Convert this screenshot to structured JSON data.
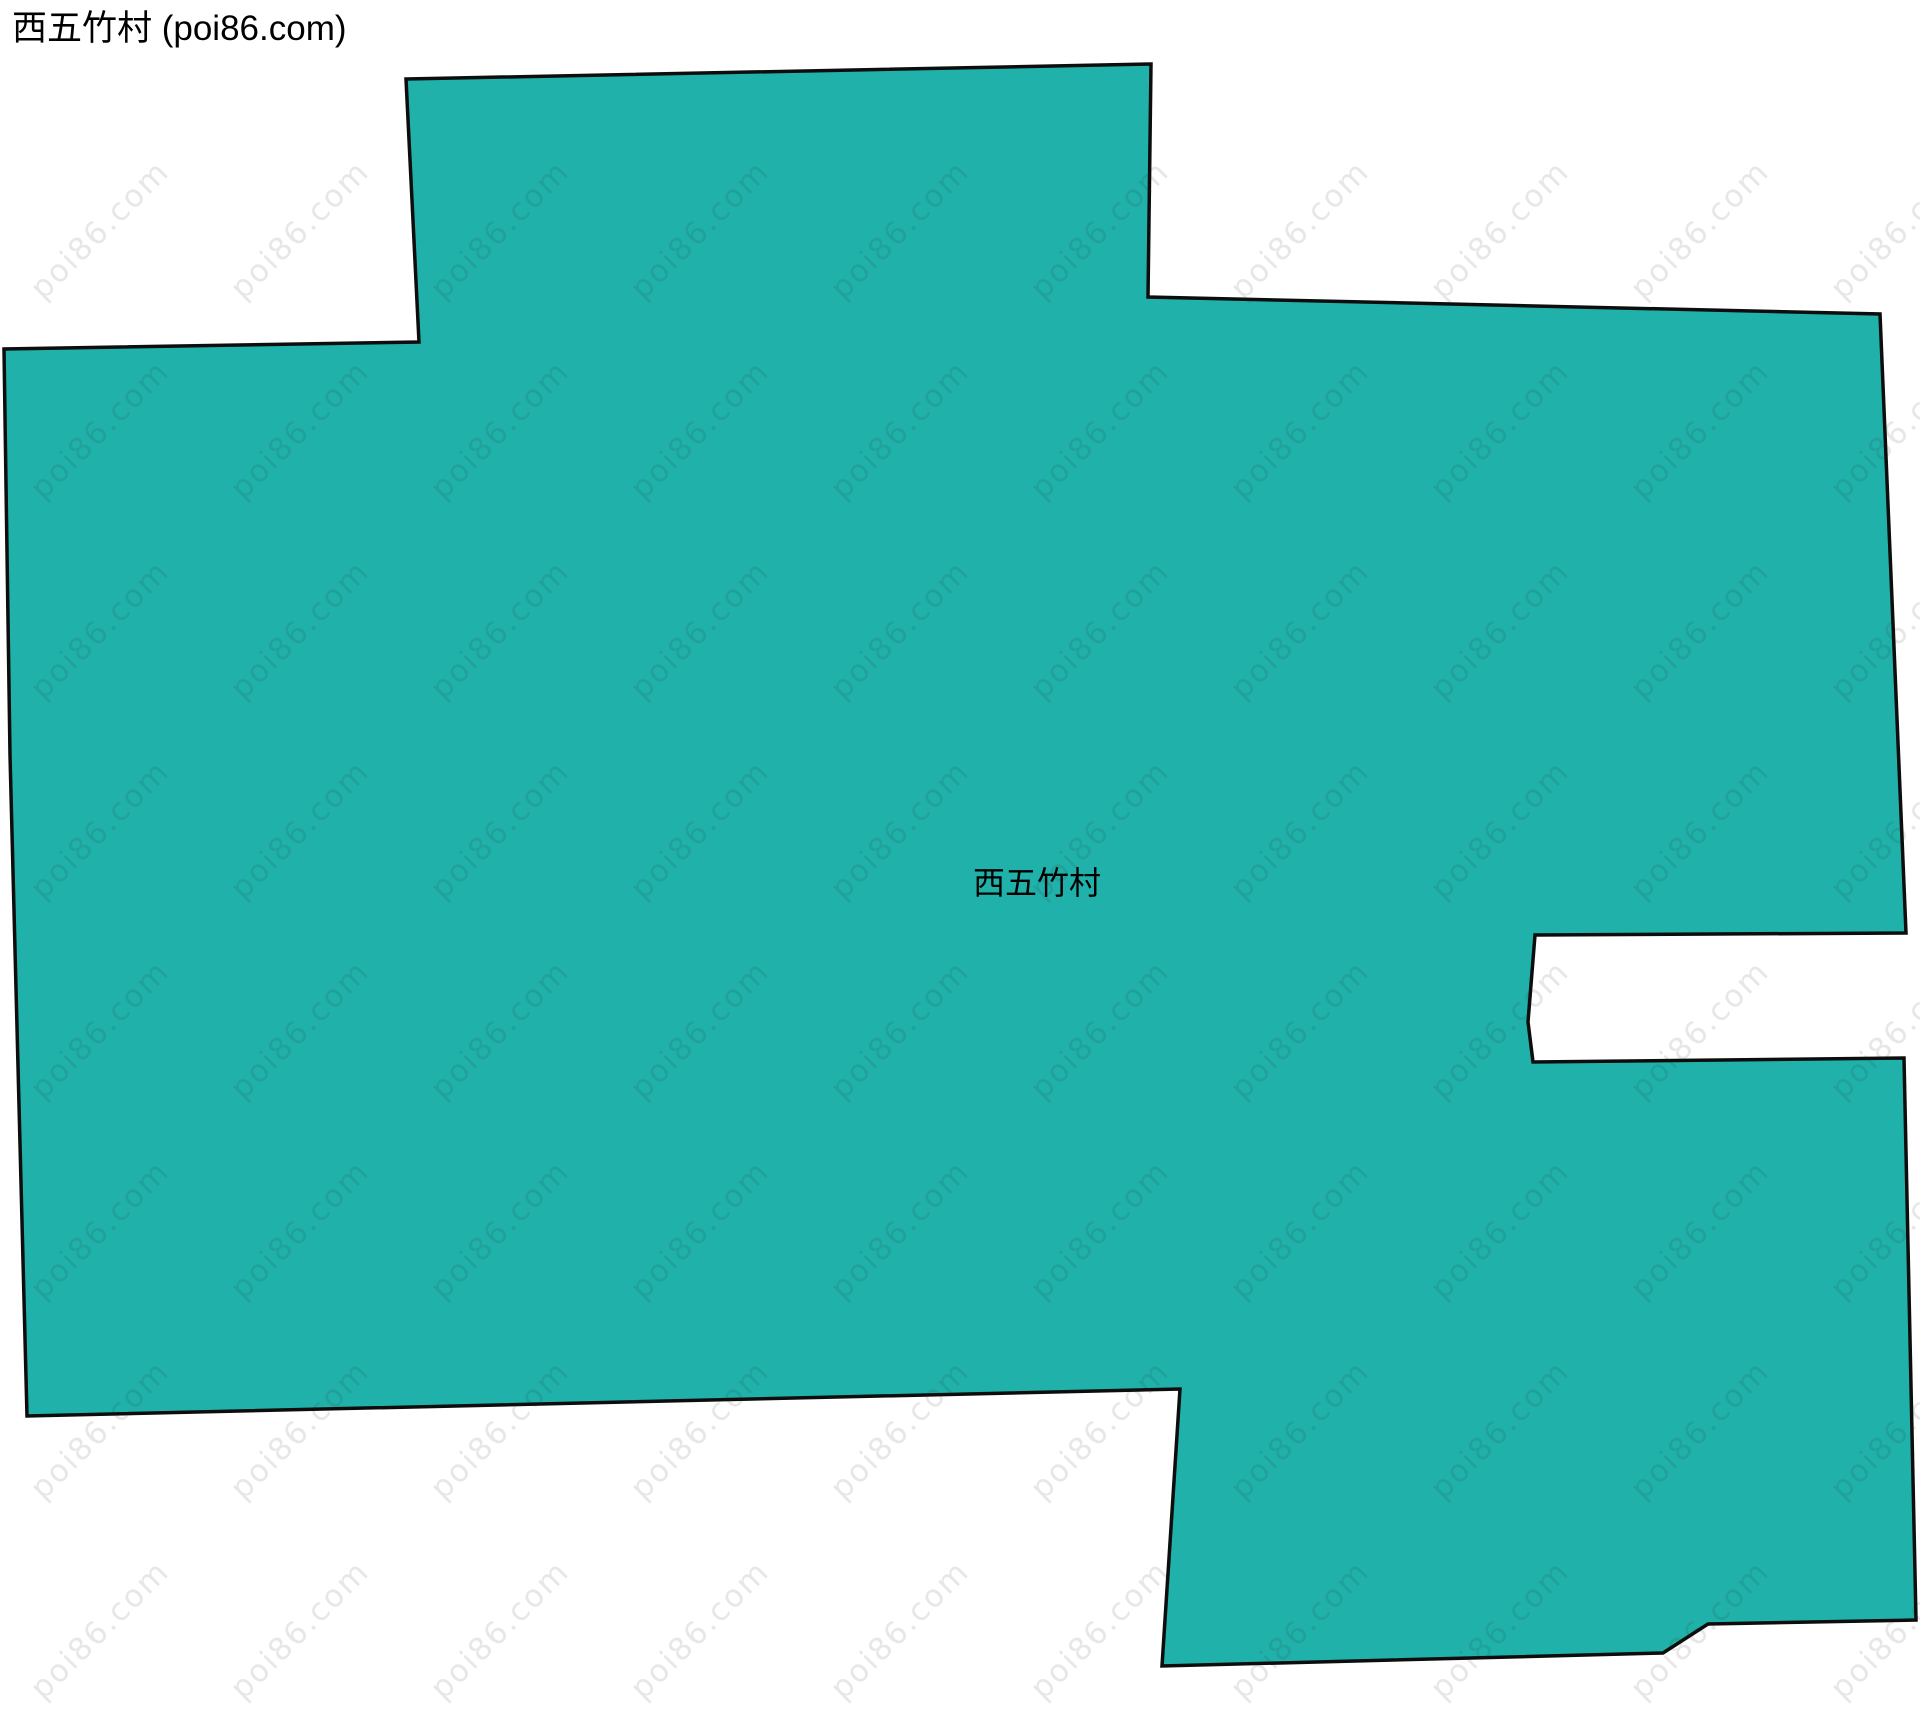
{
  "page": {
    "title": "西五竹村 (poi86.com)"
  },
  "map": {
    "region_label": "西五竹村",
    "fill_color": "#20b2aa",
    "outline_color": "#0d0d0d",
    "polygon_points": "406,79 1151,64 1148,297 1880,314 1906,933 1535,935 1528,1022 1533,1062 1904,1058 1916,1620 1708,1624 1663,1653 1162,1666 1180,1389 27,1416 10,755 4,349 419,342"
  },
  "watermark": {
    "text": "poi86.com",
    "color": "rgba(40,40,40,0.11)"
  }
}
